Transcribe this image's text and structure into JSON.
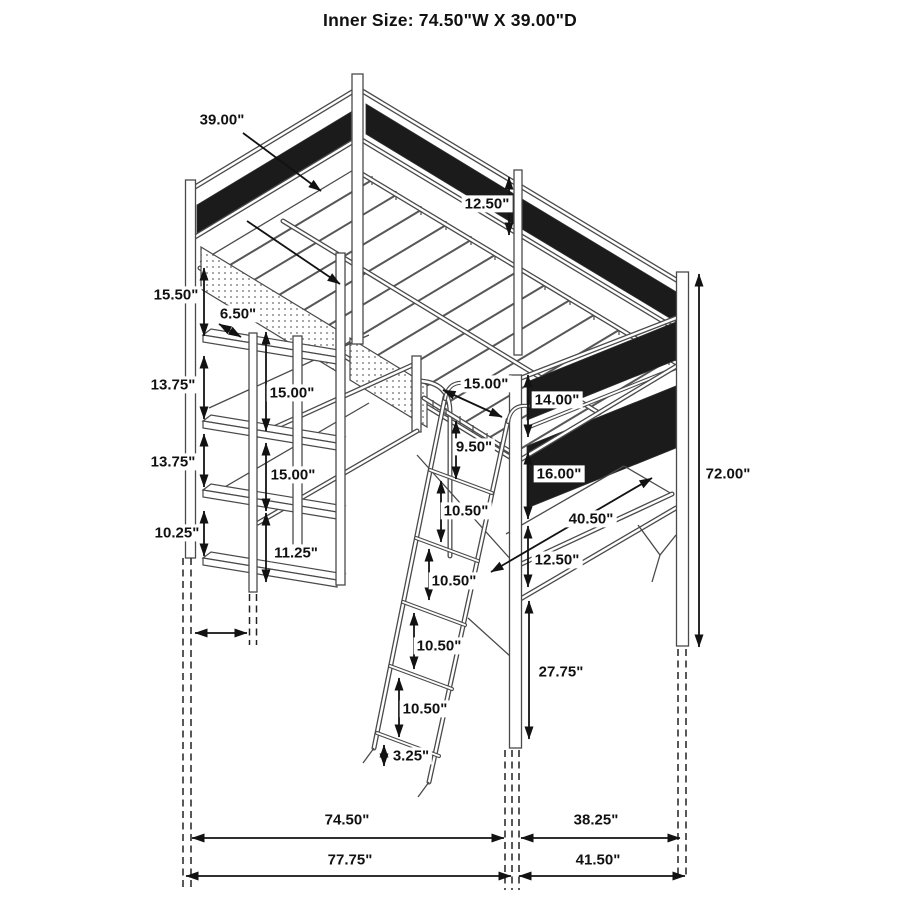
{
  "title": "Inner Size: 74.50\"W X 39.00\"D",
  "dims": {
    "bed_depth": "39.00\"",
    "guardrail_height": "12.50\"",
    "leg_top_to_shelf": "15.50\"",
    "side_shelf_depth": "6.50\"",
    "shelf_gap_1": "13.75\"",
    "shelf_to_desk_upper": "15.00\"",
    "shelf_gap_2": "13.75\"",
    "desk_to_lower_shelf": "15.00\"",
    "shelf_gap_3": "10.25\"",
    "lower_shelf_height": "11.25\"",
    "rail_to_ladder": "15.00\"",
    "right_panel_upper": "14.00\"",
    "ladder_top_to_step": "9.50\"",
    "right_panel_lower": "16.00\"",
    "right_desk_width": "40.50\"",
    "ladder_step_2": "10.50\"",
    "ladder_step_3": "10.50\"",
    "ladder_step_4": "10.50\"",
    "ladder_step_5": "10.50\"",
    "desk_to_lower_rail": "12.50\"",
    "right_leg_lower": "27.75\"",
    "ladder_foot": "3.25\"",
    "overall_height": "72.00\"",
    "inner_width": "74.50\"",
    "overall_width": "77.75\"",
    "right_inner_depth": "38.25\"",
    "right_overall_depth": "41.50\""
  }
}
